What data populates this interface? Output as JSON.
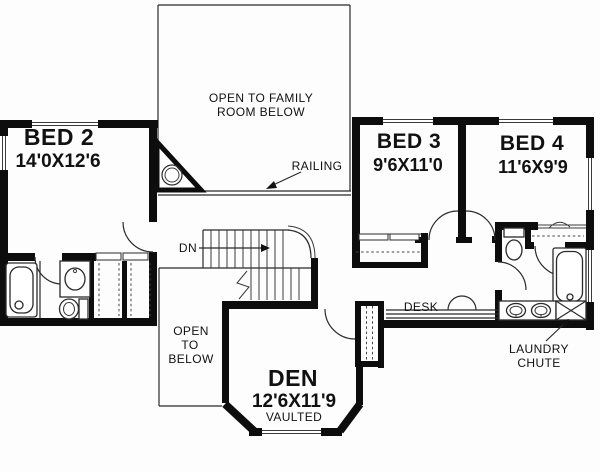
{
  "title": "Second floor plan",
  "colors": {
    "background": "#fdfdfd",
    "walls": "#0d0d0d",
    "thin_lines": "#2a2a2a",
    "text": "#111111"
  },
  "rooms": {
    "bed2": {
      "name": "BED 2",
      "dims": "14'0X12'6"
    },
    "bed3": {
      "name": "BED 3",
      "dims": "9'6X11'0"
    },
    "bed4": {
      "name": "BED 4",
      "dims": "11'6X9'9"
    },
    "den": {
      "name": "DEN",
      "dims": "12'6X11'9",
      "note": "VAULTED"
    }
  },
  "annotations": {
    "open_to_family": {
      "line1": "OPEN TO FAMILY",
      "line2": "ROOM BELOW"
    },
    "railing": "RAILING",
    "down": "DN",
    "open_to_below": {
      "line1": "OPEN",
      "line2": "TO",
      "line3": "BELOW"
    },
    "desk": "DESK",
    "laundry_chute": {
      "line1": "LAUNDRY",
      "line2": "CHUTE"
    }
  },
  "fixtures": [
    "bathtub-left",
    "vanity-sink-left",
    "toilet-left",
    "linen-closets",
    "fireplace-chimney",
    "staircase-down",
    "den-closet",
    "desk-counter",
    "water-closet-toilet",
    "double-sink-vanity",
    "bathtub-right",
    "laundry-chute-box",
    "bed3-closet",
    "bed4-closet"
  ]
}
